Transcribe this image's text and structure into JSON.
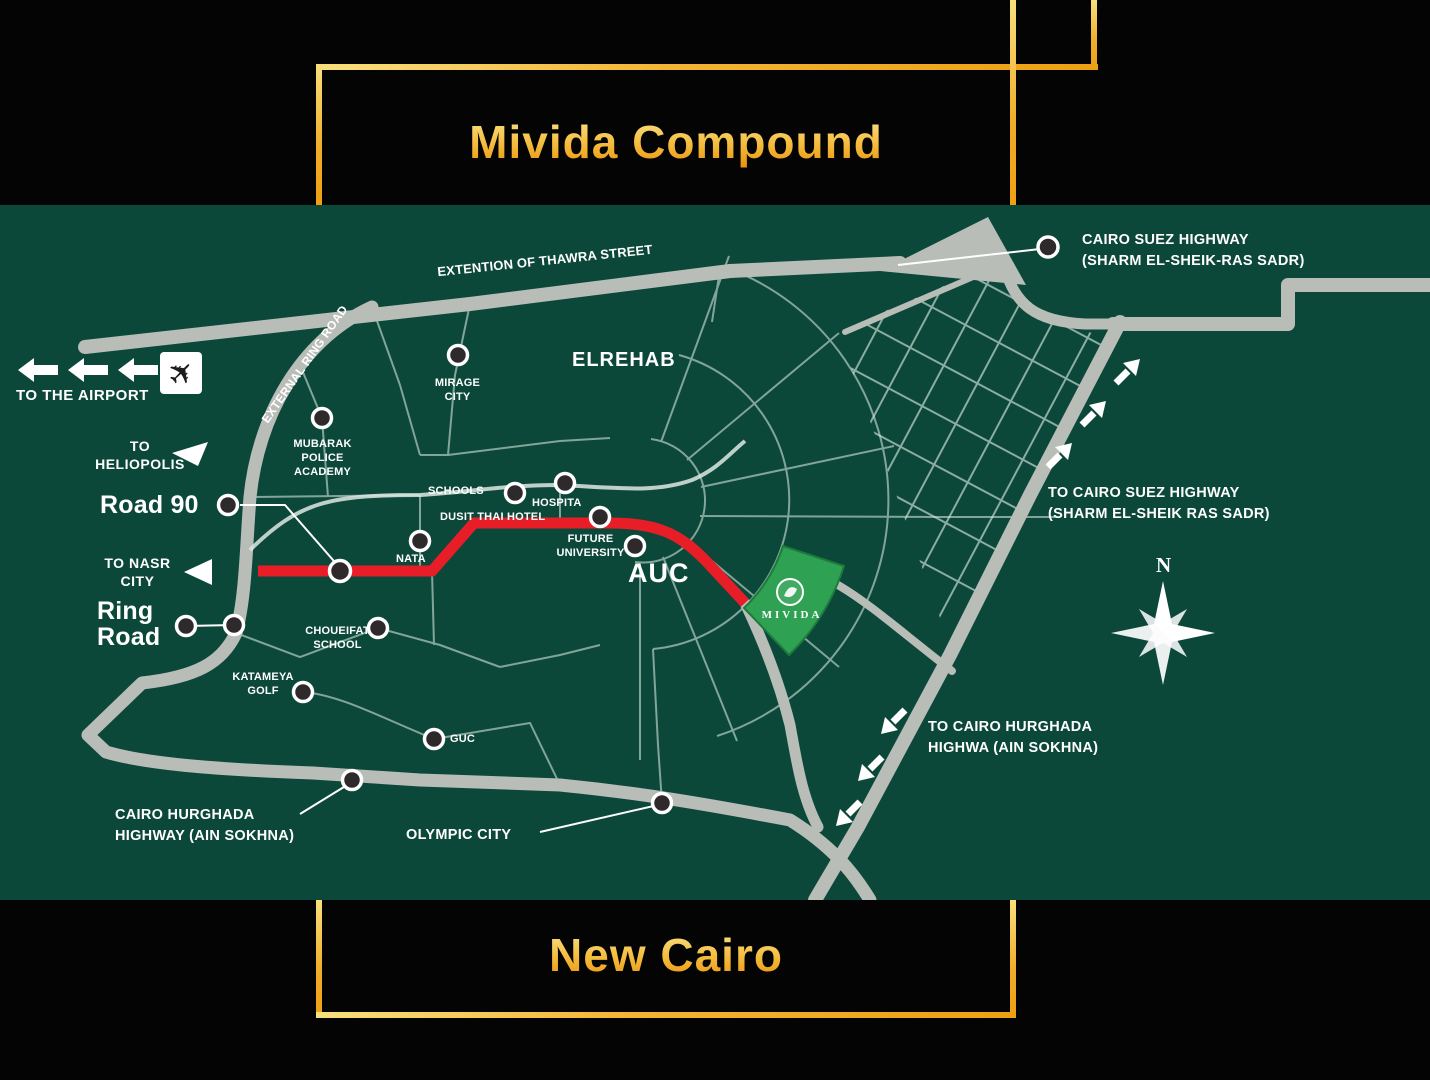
{
  "header": {
    "title": "Mivida Compound"
  },
  "footer": {
    "title": "New Cairo"
  },
  "palette": {
    "frame_gold": "#f3b434",
    "map_green": "#0c4839",
    "road_gray": "#b9bdb8",
    "highlight_red": "#e71e28",
    "mivida_green": "#2ea152",
    "label_white": "#ffffff"
  },
  "map": {
    "labels": {
      "thawra_street": "EXTENTION OF THAWRA STREET",
      "cairo_suez_hwy": "CAIRO SUEZ HIGHWAY\n(SHARM EL-SHEIK-RAS SADR)",
      "to_cairo_suez": "TO CAIRO SUEZ HIGHWAY\n(SHARM EL-SHEIK RAS SADR)",
      "to_cairo_hurghada": "TO CAIRO HURGHADA\nHIGHWA   (AIN SOKHNA)",
      "cairo_hurghada": "CAIRO HURGHADA\nHIGHWAY (AIN SOKHNA)",
      "olympic_city": "OLYMPIC CITY",
      "to_airport": "TO THE AIRPORT",
      "to_heliopolis": "TO\nHELIOPOLIS",
      "road_90": "Road 90",
      "to_nasr_city": "TO NASR\nCITY",
      "ring_road": "Ring\nRoad",
      "external_ring_road": "EXTERNAL RING ROAD",
      "mirage_city": "MIRAGE\nCITY",
      "mubarak_academy": "MUBARAK\nPOLICE\nACADEMY",
      "elrehab": "ELREHAB",
      "schools": "SCHOOLS",
      "hospital": "HOSPITA",
      "dusit_thai_hotel": "DUSIT THAI HOTEL",
      "future_university": "FUTURE\nUNIVERSITY",
      "auc": "AUC",
      "nata": "NATA",
      "choueifat_school": "CHOUEIFAT\nSCHOOL",
      "katameya_golf": "KATAMEYA\nGOLF",
      "guc": "GUC",
      "mivida_area": "MIVIDA",
      "compass_north": "N"
    }
  }
}
